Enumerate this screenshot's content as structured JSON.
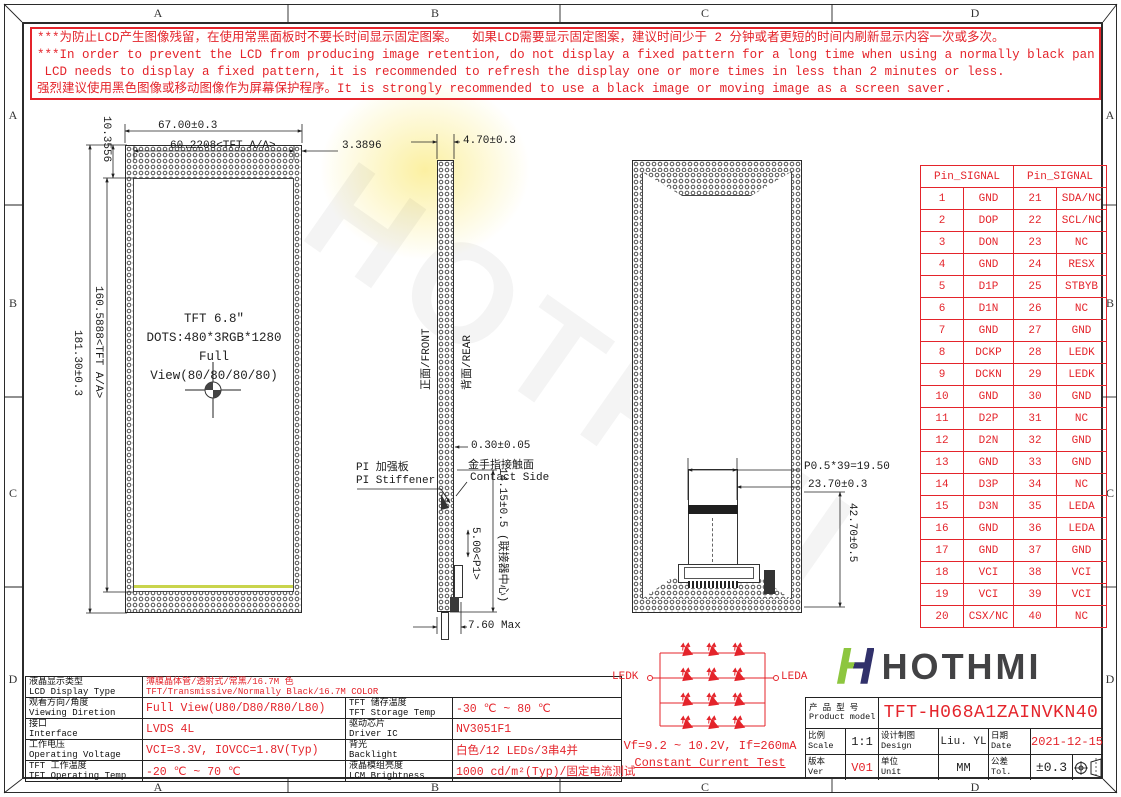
{
  "frame": {
    "grid": [
      "A",
      "B",
      "C",
      "D"
    ]
  },
  "warning": {
    "lines": [
      "***为防止LCD产生图像残留，在使用常黑面板时不要长时间显示固定图案。  如果LCD需要显示固定图案，建议时间少于 2 分钟或者更短的时间内刷新显示内容一次或多次。",
      "***In order to prevent the LCD from producing image retention, do not display a fixed pattern for a long time when using a normally black panel. If the",
      " LCD needs to display a fixed pattern, it is recommended to refresh the display one or more times in less than 2 minutes or less.",
      "强烈建议使用黑色图像或移动图像作为屏幕保护程序。It is strongly recommended to use a black image or moving image as a screen saver."
    ]
  },
  "front_view": {
    "dim_width_outer": "67.00±0.3",
    "dim_width_aa": "60.2208<TFT A/A>",
    "dim_offset_right": "3.3896",
    "dim_offset_top": "10.3556",
    "dim_height_aa": "160.5888<TFT A/A>",
    "dim_height_outer": "181.30±0.3",
    "label_size": "TFT 6.8″",
    "label_dots": "DOTS:480*3RGB*1280",
    "label_view": "Full View(80/80/80/80)"
  },
  "side_view": {
    "dim_thickness": "4.70±0.3",
    "label_front": "正面/FRONT",
    "label_rear": "背面/REAR",
    "dim_fpc_thickness": "0.30±0.05",
    "label_contact_cn": "金手指接触面",
    "label_contact_en": "Contact Side",
    "label_stiffener_cn": "PI 加强板",
    "label_stiffener_en": "PI Stiffener",
    "dim_pitch": "5.00<P1>",
    "dim_connector_center": "14.15±0.5 (联接器中心)",
    "dim_max": "7.60 Max"
  },
  "rear_view": {
    "dim_fpc_pitch": "P0.5*39=19.50",
    "dim_fpc_width": "23.70±0.3",
    "dim_fpc_length": "42.70±0.5"
  },
  "pin_table": {
    "header_left": "Pin_SIGNAL",
    "header_right": "Pin_SIGNAL",
    "rows": [
      [
        "1",
        "GND",
        "21",
        "SDA/NC"
      ],
      [
        "2",
        "DOP",
        "22",
        "SCL/NC"
      ],
      [
        "3",
        "DON",
        "23",
        "NC"
      ],
      [
        "4",
        "GND",
        "24",
        "RESX"
      ],
      [
        "5",
        "D1P",
        "25",
        "STBYB"
      ],
      [
        "6",
        "D1N",
        "26",
        "NC"
      ],
      [
        "7",
        "GND",
        "27",
        "GND"
      ],
      [
        "8",
        "DCKP",
        "28",
        "LEDK"
      ],
      [
        "9",
        "DCKN",
        "29",
        "LEDK"
      ],
      [
        "10",
        "GND",
        "30",
        "GND"
      ],
      [
        "11",
        "D2P",
        "31",
        "NC"
      ],
      [
        "12",
        "D2N",
        "32",
        "GND"
      ],
      [
        "13",
        "GND",
        "33",
        "GND"
      ],
      [
        "14",
        "D3P",
        "34",
        "NC"
      ],
      [
        "15",
        "D3N",
        "35",
        "LEDA"
      ],
      [
        "16",
        "GND",
        "36",
        "LEDA"
      ],
      [
        "17",
        "GND",
        "37",
        "GND"
      ],
      [
        "18",
        "VCI",
        "38",
        "VCI"
      ],
      [
        "19",
        "VCI",
        "39",
        "VCI"
      ],
      [
        "20",
        "CSX/NC",
        "40",
        "NC"
      ]
    ]
  },
  "spec_table": {
    "row1": {
      "label_cn": "液晶显示类型",
      "label_en": "LCD Display Type",
      "value_cn": "薄膜晶体管/透射式/常黑/16.7M 色",
      "value_en": "TFT/Transmissive/Normally Black/16.7M COLOR"
    },
    "rows": [
      {
        "l1cn": "观看方向/角度",
        "l1en": "Viewing Diretion",
        "v1": "Full View(U80/D80/R80/L80)",
        "l2cn": "TFT 储存温度",
        "l2en": "TFT Storage Temp",
        "v2": "-30 ℃ ~ 80 ℃"
      },
      {
        "l1cn": "接口",
        "l1en": "Interface",
        "v1": "LVDS 4L",
        "l2cn": "驱动芯片",
        "l2en": "Driver IC",
        "v2": "NV3051F1"
      },
      {
        "l1cn": "工作电压",
        "l1en": "Operating Voltage",
        "v1": "VCI=3.3V, IOVCC=1.8V(Typ)",
        "l2cn": "背光",
        "l2en": "Backlight",
        "v2": "白色/12 LEDs/3串4并"
      },
      {
        "l1cn": "TFT 工作温度",
        "l1en": "TFT Operating Temp",
        "v1": "-20 ℃ ~ 70 ℃",
        "l2cn": "液晶模组亮度",
        "l2en": "LCM Brightness",
        "v2": "1000 cd/m²(Typ)/固定电流测试"
      }
    ]
  },
  "led_circuit": {
    "label_ledk": "LEDK",
    "label_leda": "LEDA",
    "vf_text": "Vf=9.2 ~ 10.2V, If=260mA",
    "test_text": "Constant Current Test"
  },
  "title_block": {
    "logo_mark": "H",
    "logo_word": "HOTHMI",
    "product_label_cn": "产 品 型 号",
    "product_label_en": "Product model",
    "product_model": "TFT-H068A1ZAINVKN40",
    "scale_cn": "比例",
    "scale_en": "Scale",
    "scale_value": "1:1",
    "design_cn": "设计制图",
    "design_en": "Design",
    "design_value": "Liu. YL",
    "date_cn": "日期",
    "date_en": "Date",
    "date_value": "2021-12-15",
    "ver_cn": "版本",
    "ver_en": "Ver",
    "ver_value": "V01",
    "unit_cn": "单位",
    "unit_en": "Unit",
    "unit_value": "MM",
    "tol_cn": "公差",
    "tol_en": "Tol.",
    "tol_value": "±0.3"
  },
  "watermark": {
    "text": "HOTHMI"
  },
  "colors": {
    "red": "#e4242b",
    "logo_green": "#8dc63f",
    "logo_navy": "#31316b"
  }
}
